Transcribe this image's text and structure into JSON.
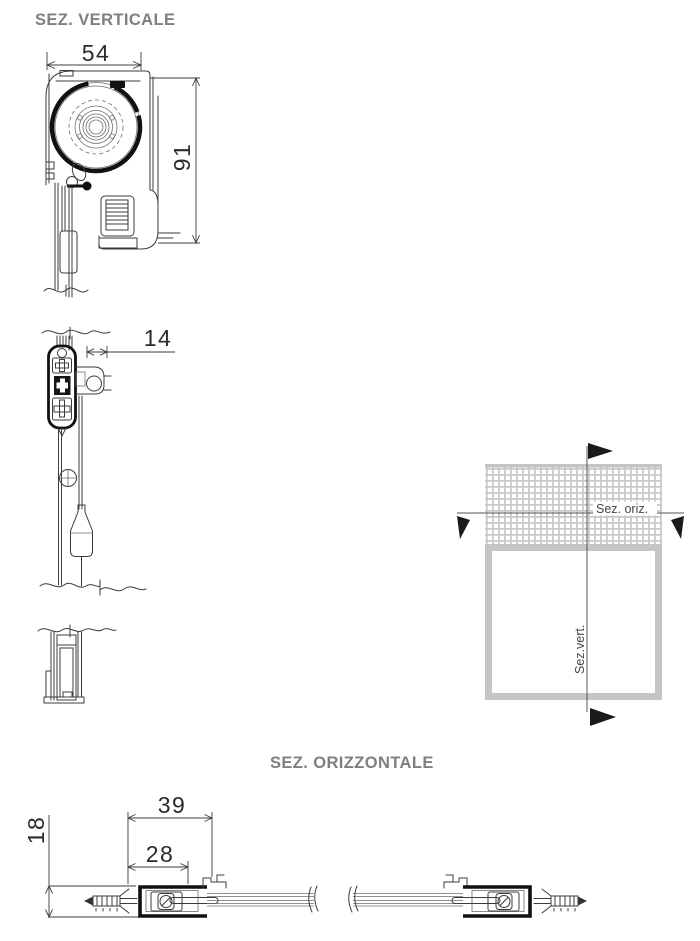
{
  "titles": {
    "vertical_section": "SEZ. VERTICALE",
    "horizontal_section": "SEZ. ORIZZONTALE"
  },
  "vertical_section": {
    "dimensions": {
      "box_width": "54",
      "box_height": "91",
      "bottom_bar_depth": "14"
    }
  },
  "horizontal_section": {
    "dimensions": {
      "assembly_depth": "39",
      "guide_channel_depth": "28",
      "guide_channel_height": "18"
    }
  },
  "window_schematic": {
    "horizontal_cut_label": "Sez. oriz.",
    "vertical_cut_label": "Sez.vert."
  },
  "colors": {
    "title_gray": "#7f7f7f",
    "drawing_line": "#3c3c3c",
    "thick_line": "#111111",
    "schematic_frame": "#c5c5c5",
    "mesh_grid": "#c9c9c9",
    "cut_label": "#454545",
    "dimension_text": "#2b2b2b"
  }
}
